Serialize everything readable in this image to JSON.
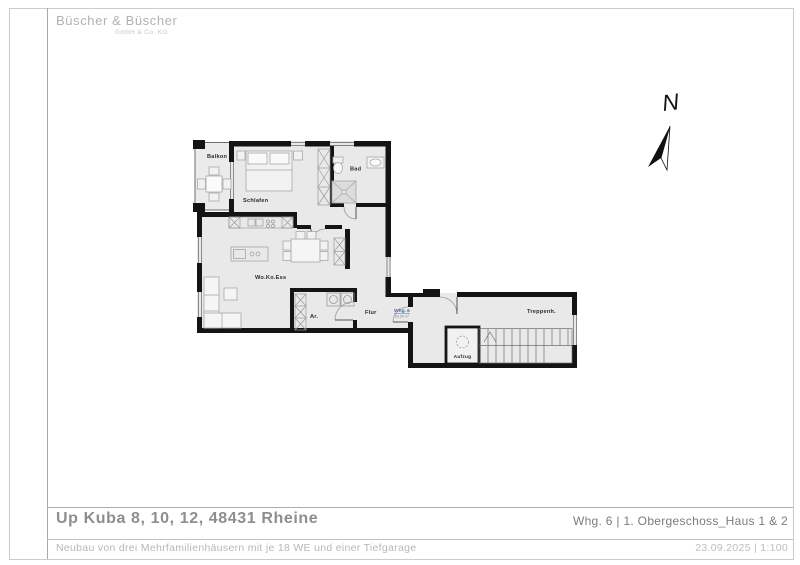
{
  "logo": {
    "name": "Büscher & Büscher",
    "sub": "GmbH & Co. KG"
  },
  "titleblock": {
    "project_title": "Up Kuba 8, 10, 12, 48431 Rheine",
    "project_subtitle": "Neubau von drei Mehrfamilienhäusern mit je 18 WE und einer Tiefgarage",
    "sheet_title": "Whg. 6 | 1. Obergeschoss_Haus 1 & 2",
    "date_scale": "23.09.2025 | 1:100"
  },
  "compass": {
    "label": "N"
  },
  "plan": {
    "rooms": [
      {
        "id": "balkon",
        "label": "Balkon"
      },
      {
        "id": "schlafen",
        "label": "Schlafen"
      },
      {
        "id": "bad",
        "label": "Bad"
      },
      {
        "id": "wokoess",
        "label": "Wo.Ko.Ess"
      },
      {
        "id": "ar",
        "label": "Ar."
      },
      {
        "id": "flur",
        "label": "Flur"
      },
      {
        "id": "treppenhaus",
        "label": "Treppenh."
      },
      {
        "id": "aufzug",
        "label": "Aufzug"
      }
    ],
    "apartment_tag": {
      "name": "Whg. 6",
      "area": "86,56 m²"
    },
    "colors": {
      "wall": "#141414",
      "room_fill": "#e9e9e9",
      "furniture": "#a8a8a8",
      "tag_blue": "#3a6bbf"
    }
  }
}
